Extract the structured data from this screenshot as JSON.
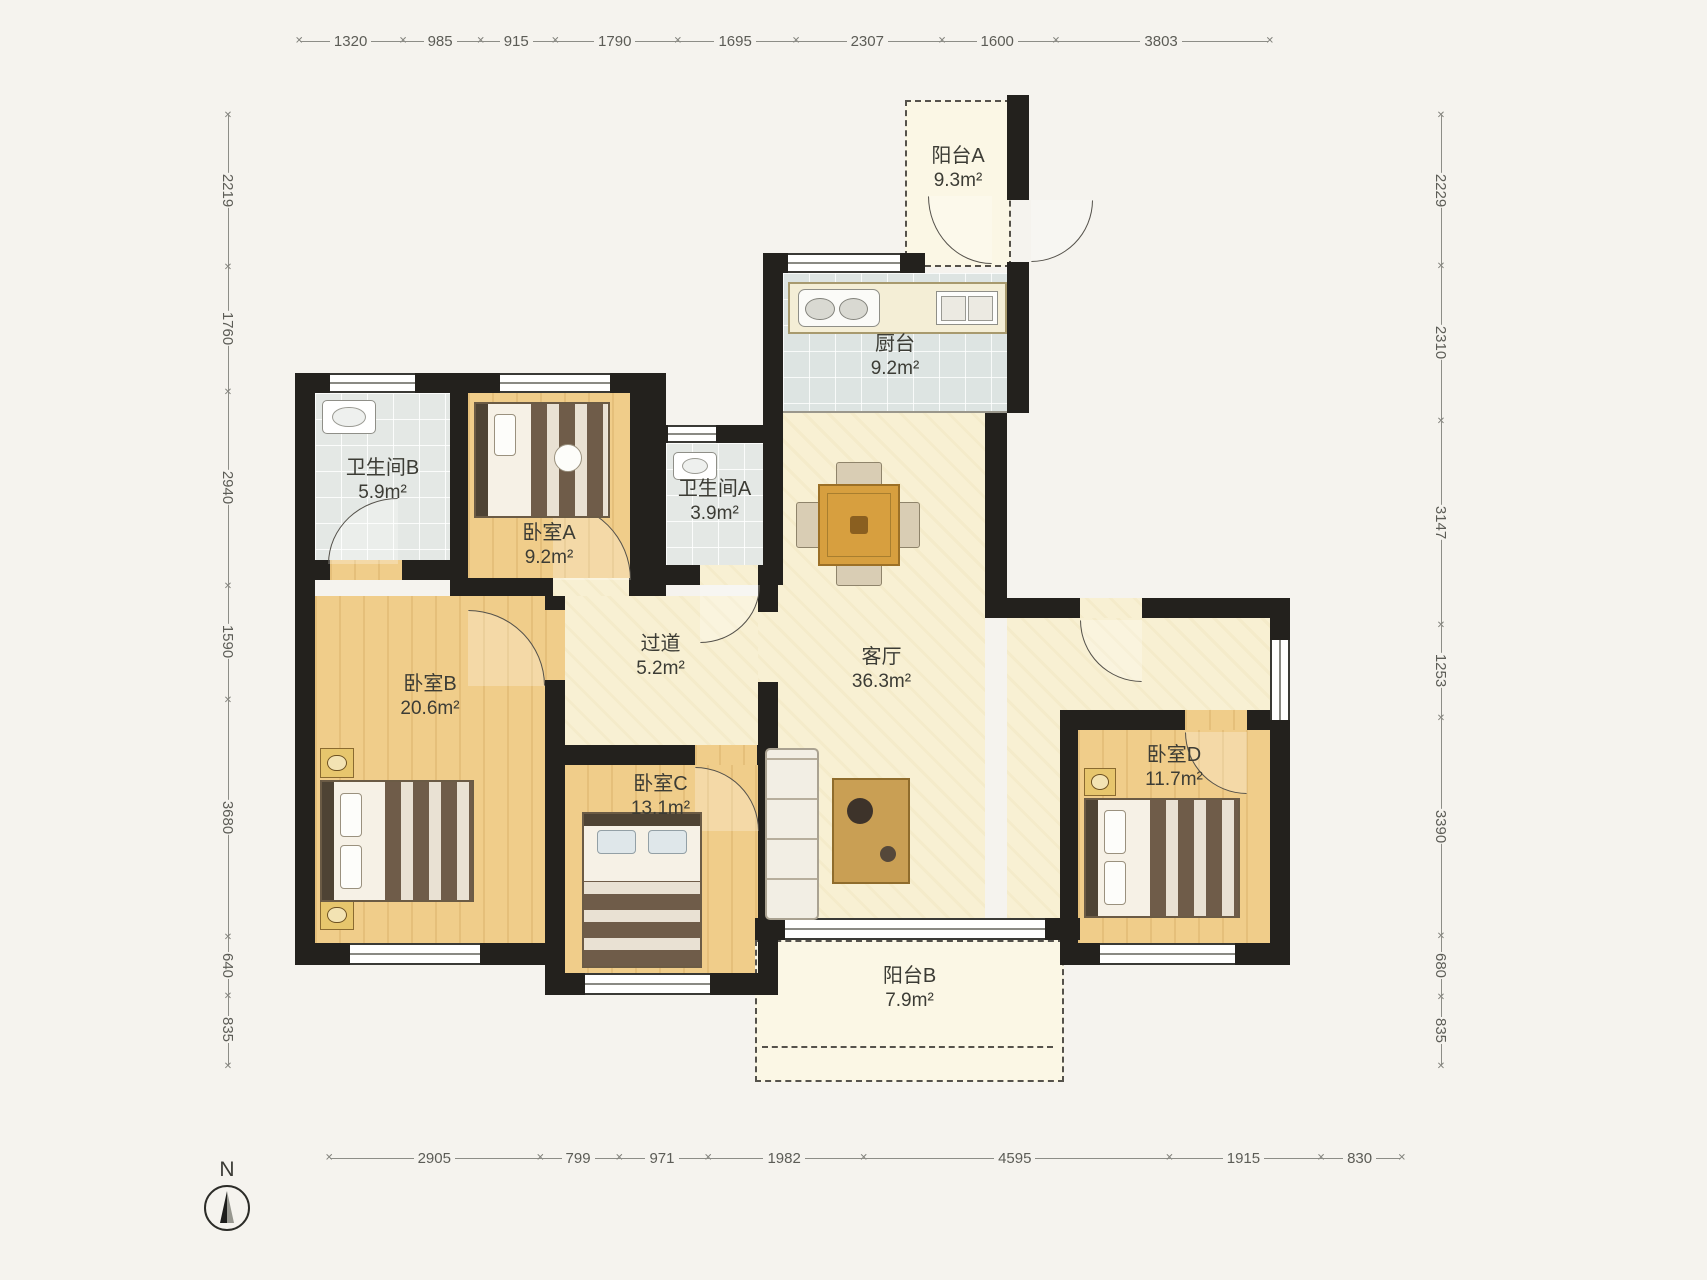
{
  "plan": {
    "rooms": {
      "balcony_a": {
        "name": "阳台A",
        "area": "9.3m²"
      },
      "kitchen": {
        "name": "厨台",
        "area": "9.2m²"
      },
      "bath_b": {
        "name": "卫生间B",
        "area": "5.9m²"
      },
      "bedroom_a": {
        "name": "卧室A",
        "area": "9.2m²"
      },
      "bath_a": {
        "name": "卫生间A",
        "area": "3.9m²"
      },
      "hallway": {
        "name": "过道",
        "area": "5.2m²"
      },
      "living_room": {
        "name": "客厅",
        "area": "36.3m²"
      },
      "bedroom_b": {
        "name": "卧室B",
        "area": "20.6m²"
      },
      "bedroom_c": {
        "name": "卧室C",
        "area": "13.1m²"
      },
      "bedroom_d": {
        "name": "卧室D",
        "area": "11.7m²"
      },
      "balcony_b": {
        "name": "阳台B",
        "area": "7.9m²"
      }
    },
    "dimensions": {
      "top": [
        "1320",
        "985",
        "915",
        "1790",
        "1695",
        "2307",
        "1600",
        "3803"
      ],
      "left": [
        "2219",
        "1760",
        "2940",
        "1590",
        "3680",
        "640",
        "835"
      ],
      "right": [
        "2229",
        "2310",
        "3147",
        "1253",
        "3390",
        "680",
        "835"
      ],
      "bottom": [
        "2905",
        "799",
        "971",
        "1982",
        "4595",
        "1915",
        "830"
      ]
    },
    "compass": {
      "label": "N"
    },
    "colors": {
      "wall": "#23211d",
      "wood_floor": "#f0cd8a",
      "cream_floor": "#f8f0d3",
      "bath_tile": "#e4e8e5",
      "kitchen_tile": "#dde4e2",
      "balcony_floor": "#fbf7e5"
    }
  }
}
